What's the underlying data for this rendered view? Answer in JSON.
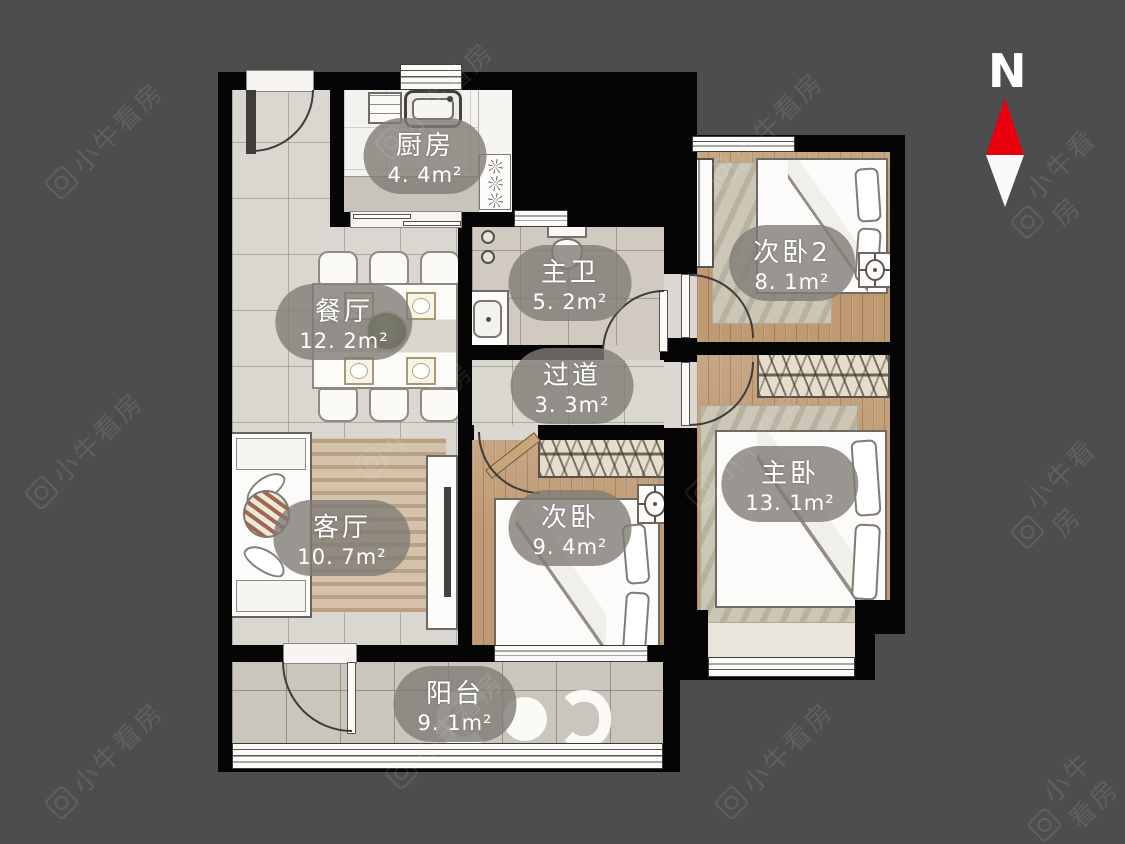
{
  "watermark": {
    "text": "小牛看房"
  },
  "compass": {
    "label": "N"
  },
  "rooms": [
    {
      "id": "kitchen",
      "name": "厨房",
      "area": "4. 4m²"
    },
    {
      "id": "bedroom2",
      "name": "次卧2",
      "area": "8. 1m²"
    },
    {
      "id": "master-bath",
      "name": "主卫",
      "area": "5. 2m²"
    },
    {
      "id": "dining",
      "name": "餐厅",
      "area": "12. 2m²"
    },
    {
      "id": "hallway",
      "name": "过道",
      "area": "3. 3m²"
    },
    {
      "id": "master-bedroom",
      "name": "主卧",
      "area": "13. 1m²"
    },
    {
      "id": "living",
      "name": "客厅",
      "area": "10. 7m²"
    },
    {
      "id": "bedroom",
      "name": "次卧",
      "area": "9. 4m²"
    },
    {
      "id": "balcony",
      "name": "阳台",
      "area": "9. 1m²"
    }
  ],
  "colors": {
    "background": "#4d4d4d",
    "wall": "#050505",
    "tile_floor": "#dad6d0",
    "wood_floor": "#c09a73",
    "label_pill": "rgba(127,124,117,0.8)",
    "compass_north": "#e8000f"
  }
}
